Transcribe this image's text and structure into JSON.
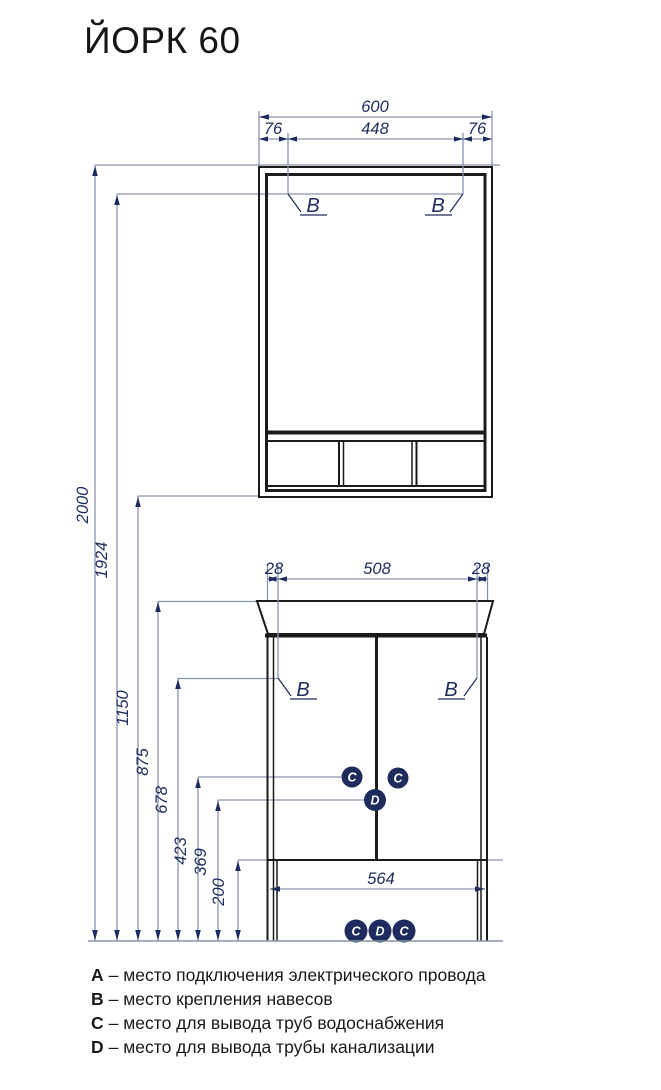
{
  "title": "ЙОРК 60",
  "colors": {
    "drawing_line": "#1b1b1b",
    "dimension_line": "#8a93ae",
    "dimension_text": "#1d2c5d",
    "marker_fill": "#1d2c5d"
  },
  "mirror_cabinet_dims": {
    "total_width": "600",
    "left_offset": "76",
    "hanger_span": "448",
    "right_offset": "76"
  },
  "vanity_dims": {
    "left_offset": "28",
    "hanger_span": "508",
    "right_offset": "28",
    "base_width": "564"
  },
  "height_dims": {
    "h2000": "2000",
    "h1924": "1924",
    "h1150": "1150",
    "h875": "875",
    "h678": "678",
    "h423": "423",
    "h369": "369",
    "h200": "200"
  },
  "markers": {
    "hanger": "B",
    "water": "C",
    "drain": "D"
  },
  "legend": {
    "rows": [
      {
        "key": "A",
        "text": "– место подключения электрического провода"
      },
      {
        "key": "B",
        "text": "– место крепления навесов"
      },
      {
        "key": "C",
        "text": "– место для вывода труб водоснабжения"
      },
      {
        "key": "D",
        "text": "– место для вывода трубы канализации"
      }
    ]
  }
}
